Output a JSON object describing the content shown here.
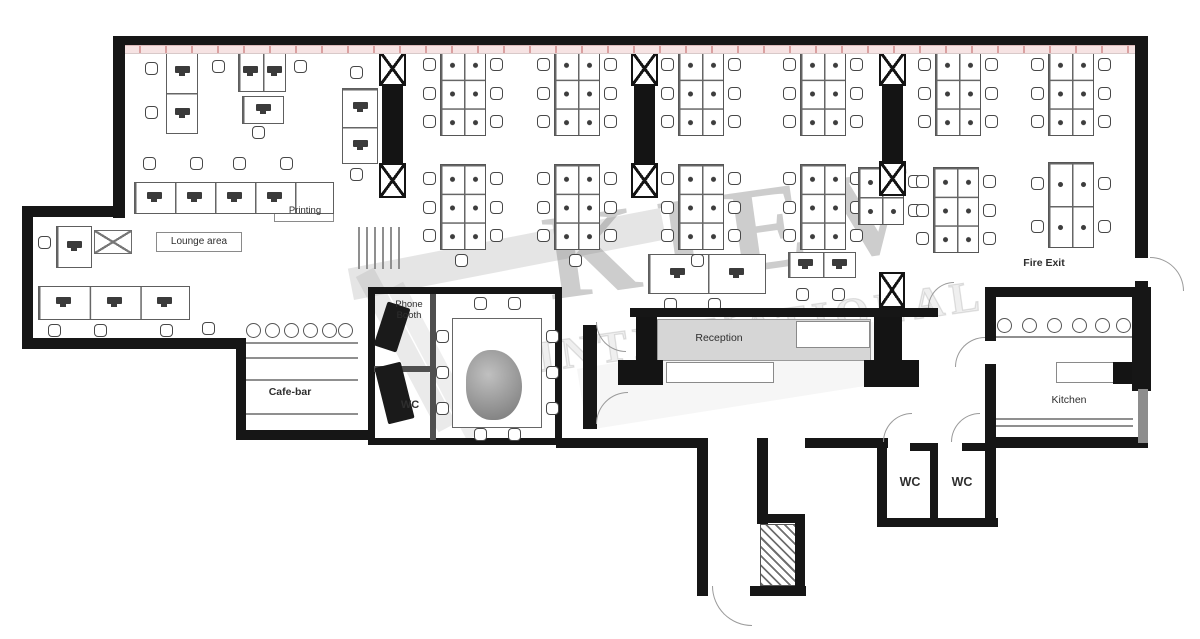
{
  "watermark": {
    "line1": "KIEV",
    "line2": "INTERNATIONAL"
  },
  "labels": {
    "printing": "Printing",
    "lounge": "Lounge area",
    "cafe": "Cafe-bar",
    "phone_booth": "Phone Booth",
    "wc_small": "WC",
    "reception": "Reception",
    "fire_exit": "Fire Exit",
    "kitchen": "Kitchen",
    "wc1": "WC",
    "wc2": "WC"
  },
  "colors": {
    "wall": "#161616",
    "window_band": "#f6e3e3",
    "band_tick": "#c36969",
    "furniture_line": "#5e5e5e",
    "watermark": "rgba(75,75,75,0.28)"
  },
  "plan": {
    "band": {
      "x": 113,
      "y": 45,
      "w": 1035,
      "h": 9
    },
    "walls": [
      {
        "x": 113,
        "y": 36,
        "w": 1035,
        "h": 9
      },
      {
        "x": 113,
        "y": 36,
        "w": 12,
        "h": 182
      },
      {
        "x": 22,
        "y": 206,
        "w": 103,
        "h": 11
      },
      {
        "x": 22,
        "y": 206,
        "w": 11,
        "h": 143
      },
      {
        "x": 22,
        "y": 338,
        "w": 224,
        "h": 11
      },
      {
        "x": 236,
        "y": 338,
        "w": 10,
        "h": 102
      },
      {
        "x": 236,
        "y": 430,
        "w": 137,
        "h": 10
      },
      {
        "x": 556,
        "y": 438,
        "w": 152,
        "h": 10
      },
      {
        "x": 697,
        "y": 438,
        "w": 11,
        "h": 158
      },
      {
        "x": 757,
        "y": 438,
        "w": 11,
        "h": 86
      },
      {
        "x": 757,
        "y": 514,
        "w": 48,
        "h": 9
      },
      {
        "x": 795,
        "y": 514,
        "w": 10,
        "h": 82
      },
      {
        "x": 750,
        "y": 586,
        "w": 56,
        "h": 10
      },
      {
        "x": 805,
        "y": 438,
        "w": 83,
        "h": 10
      },
      {
        "x": 877,
        "y": 438,
        "w": 10,
        "h": 88
      },
      {
        "x": 910,
        "y": 443,
        "w": 27,
        "h": 8
      },
      {
        "x": 930,
        "y": 443,
        "w": 8,
        "h": 83
      },
      {
        "x": 962,
        "y": 443,
        "w": 27,
        "h": 8
      },
      {
        "x": 877,
        "y": 518,
        "w": 121,
        "h": 9
      },
      {
        "x": 985,
        "y": 438,
        "w": 11,
        "h": 88
      },
      {
        "x": 985,
        "y": 437,
        "w": 163,
        "h": 11
      },
      {
        "x": 985,
        "y": 287,
        "w": 11,
        "h": 54
      },
      {
        "x": 985,
        "y": 364,
        "w": 11,
        "h": 80
      },
      {
        "x": 985,
        "y": 287,
        "w": 163,
        "h": 10
      },
      {
        "x": 1132,
        "y": 287,
        "w": 19,
        "h": 104
      },
      {
        "x": 1138,
        "y": 389,
        "w": 10,
        "h": 54,
        "v": "lt"
      },
      {
        "x": 1135,
        "y": 36,
        "w": 13,
        "h": 222
      },
      {
        "x": 1135,
        "y": 281,
        "w": 13,
        "h": 12
      },
      {
        "x": 630,
        "y": 308,
        "w": 308,
        "h": 9
      },
      {
        "x": 583,
        "y": 325,
        "w": 14,
        "h": 104
      }
    ],
    "pillars": [
      {
        "x": 283,
        "y": 37,
        "w": 26,
        "h": 15
      },
      {
        "x": 378,
        "y": 37,
        "w": 26,
        "h": 15
      },
      {
        "x": 497,
        "y": 37,
        "w": 26,
        "h": 15
      },
      {
        "x": 632,
        "y": 37,
        "w": 26,
        "h": 15
      },
      {
        "x": 748,
        "y": 37,
        "w": 26,
        "h": 15
      },
      {
        "x": 878,
        "y": 37,
        "w": 26,
        "h": 15
      },
      {
        "x": 1000,
        "y": 37,
        "w": 26,
        "h": 15
      },
      {
        "x": 382,
        "y": 86,
        "w": 21,
        "h": 78
      },
      {
        "x": 634,
        "y": 86,
        "w": 21,
        "h": 78
      },
      {
        "x": 882,
        "y": 86,
        "w": 21,
        "h": 78
      },
      {
        "x": 636,
        "y": 315,
        "w": 21,
        "h": 48
      },
      {
        "x": 618,
        "y": 360,
        "w": 45,
        "h": 25
      },
      {
        "x": 874,
        "y": 316,
        "w": 28,
        "h": 46
      },
      {
        "x": 864,
        "y": 360,
        "w": 55,
        "h": 27
      },
      {
        "x": 1113,
        "y": 362,
        "w": 22,
        "h": 22
      }
    ],
    "xboxes": [
      {
        "x": 379,
        "y": 51,
        "w": 27,
        "h": 35
      },
      {
        "x": 379,
        "y": 163,
        "w": 27,
        "h": 35
      },
      {
        "x": 631,
        "y": 51,
        "w": 27,
        "h": 35
      },
      {
        "x": 631,
        "y": 163,
        "w": 27,
        "h": 35
      },
      {
        "x": 879,
        "y": 51,
        "w": 27,
        "h": 35
      },
      {
        "x": 879,
        "y": 161,
        "w": 27,
        "h": 35
      },
      {
        "x": 879,
        "y": 272,
        "w": 26,
        "h": 36
      }
    ],
    "xtables": [
      {
        "x": 94,
        "y": 230,
        "w": 38,
        "h": 24
      }
    ],
    "clusters": [
      {
        "x": 440,
        "y": 50
      },
      {
        "x": 554,
        "y": 50
      },
      {
        "x": 678,
        "y": 50
      },
      {
        "x": 800,
        "y": 50
      },
      {
        "x": 935,
        "y": 50
      },
      {
        "x": 1048,
        "y": 50
      },
      {
        "x": 440,
        "y": 164
      },
      {
        "x": 554,
        "y": 164
      },
      {
        "x": 678,
        "y": 164
      },
      {
        "x": 800,
        "y": 164
      },
      {
        "x": 858,
        "y": 167,
        "w": 46,
        "h": 58,
        "r": 2,
        "nl": 1
      },
      {
        "x": 933,
        "y": 167
      },
      {
        "x": 1048,
        "y": 162,
        "r": 2
      }
    ],
    "rows": [
      {
        "x": 134,
        "y": 182,
        "w": 200,
        "h": 32,
        "cells": 5,
        "mons": [
          0,
          1,
          2,
          3
        ]
      },
      {
        "x": 38,
        "y": 286,
        "w": 152,
        "h": 34,
        "cells": 3,
        "mons": [
          0,
          1,
          2
        ]
      },
      {
        "x": 56,
        "y": 226,
        "w": 36,
        "h": 42,
        "cells": 1,
        "mons": [
          0
        ]
      },
      {
        "x": 166,
        "y": 50,
        "w": 32,
        "h": 84,
        "cells": 2,
        "vert": 1,
        "mons": [
          0,
          1
        ]
      },
      {
        "x": 238,
        "y": 52,
        "w": 48,
        "h": 40,
        "cells": 2,
        "mons": [
          0,
          1
        ]
      },
      {
        "x": 242,
        "y": 96,
        "w": 42,
        "h": 28,
        "cells": 1,
        "mons": [
          0
        ]
      },
      {
        "x": 342,
        "y": 88,
        "w": 36,
        "h": 76,
        "cells": 2,
        "vert": 1,
        "mons": [
          0,
          1
        ]
      },
      {
        "x": 648,
        "y": 254,
        "w": 118,
        "h": 40,
        "cells": 2,
        "mons": [
          0,
          1
        ]
      },
      {
        "x": 788,
        "y": 252,
        "w": 68,
        "h": 26,
        "cells": 2,
        "mons": [
          0,
          1
        ]
      }
    ],
    "chairs": [
      {
        "x": 143,
        "y": 157
      },
      {
        "x": 190,
        "y": 157
      },
      {
        "x": 233,
        "y": 157
      },
      {
        "x": 280,
        "y": 157
      },
      {
        "x": 48,
        "y": 324
      },
      {
        "x": 94,
        "y": 324
      },
      {
        "x": 160,
        "y": 324
      },
      {
        "x": 202,
        "y": 322
      },
      {
        "x": 38,
        "y": 236
      },
      {
        "x": 145,
        "y": 62
      },
      {
        "x": 145,
        "y": 106
      },
      {
        "x": 212,
        "y": 60
      },
      {
        "x": 294,
        "y": 60
      },
      {
        "x": 252,
        "y": 126
      },
      {
        "x": 350,
        "y": 66
      },
      {
        "x": 350,
        "y": 168
      },
      {
        "x": 664,
        "y": 298
      },
      {
        "x": 708,
        "y": 298
      },
      {
        "x": 796,
        "y": 288
      },
      {
        "x": 832,
        "y": 288
      },
      {
        "x": 455,
        "y": 254
      },
      {
        "x": 569,
        "y": 254
      },
      {
        "x": 691,
        "y": 254
      },
      {
        "x": 436,
        "y": 330
      },
      {
        "x": 436,
        "y": 366
      },
      {
        "x": 436,
        "y": 402
      },
      {
        "x": 546,
        "y": 330
      },
      {
        "x": 546,
        "y": 366
      },
      {
        "x": 546,
        "y": 402
      },
      {
        "x": 474,
        "y": 297
      },
      {
        "x": 508,
        "y": 297
      },
      {
        "x": 474,
        "y": 428
      },
      {
        "x": 508,
        "y": 428
      }
    ],
    "stools": [
      {
        "x": 246,
        "y": 323
      },
      {
        "x": 265,
        "y": 323
      },
      {
        "x": 284,
        "y": 323
      },
      {
        "x": 303,
        "y": 323
      },
      {
        "x": 322,
        "y": 323
      },
      {
        "x": 338,
        "y": 323
      },
      {
        "x": 997,
        "y": 318
      },
      {
        "x": 1022,
        "y": 318
      },
      {
        "x": 1047,
        "y": 318
      },
      {
        "x": 1072,
        "y": 318
      },
      {
        "x": 1095,
        "y": 318
      },
      {
        "x": 1116,
        "y": 318
      }
    ],
    "doors": [
      {
        "x": 1150,
        "y": 257,
        "r": 34,
        "c": "tr"
      },
      {
        "x": 955,
        "y": 337,
        "r": 30,
        "c": "tl"
      },
      {
        "x": 928,
        "y": 282,
        "r": 26,
        "c": "tl"
      },
      {
        "x": 883,
        "y": 413,
        "r": 29,
        "c": "tl"
      },
      {
        "x": 951,
        "y": 413,
        "r": 29,
        "c": "tl"
      },
      {
        "x": 712,
        "y": 586,
        "r": 40,
        "c": "bl"
      },
      {
        "x": 596,
        "y": 322,
        "r": 30,
        "c": "bl"
      },
      {
        "x": 596,
        "y": 392,
        "r": 32,
        "c": "tl"
      }
    ],
    "lines": [
      {
        "x": 243,
        "y": 342,
        "w": 115,
        "h": 2
      },
      {
        "x": 243,
        "y": 357,
        "w": 115,
        "h": 1.5
      },
      {
        "x": 243,
        "y": 379,
        "w": 115,
        "h": 1.5
      },
      {
        "x": 243,
        "y": 413,
        "w": 115,
        "h": 2
      },
      {
        "x": 996,
        "y": 336,
        "w": 137,
        "h": 2
      },
      {
        "x": 996,
        "y": 418,
        "w": 137,
        "h": 1.5
      },
      {
        "x": 996,
        "y": 425,
        "w": 137,
        "h": 1.5
      },
      {
        "x": 358,
        "y": 227,
        "w": 1.5,
        "h": 42
      },
      {
        "x": 366,
        "y": 227,
        "w": 1.5,
        "h": 42
      },
      {
        "x": 374,
        "y": 227,
        "w": 1.5,
        "h": 42
      },
      {
        "x": 382,
        "y": 227,
        "w": 1.5,
        "h": 42
      },
      {
        "x": 390,
        "y": 227,
        "w": 1.5,
        "h": 42
      },
      {
        "x": 398,
        "y": 227,
        "w": 1.5,
        "h": 42
      },
      {
        "x": 799,
        "y": 333,
        "w": 68,
        "h": 1.5
      }
    ],
    "rects": [
      {
        "x": 368,
        "y": 287,
        "w": 194,
        "h": 158,
        "cls": "blockwall",
        "name": "meeting-room-walls"
      },
      {
        "x": 430,
        "y": 294,
        "w": 6,
        "h": 146,
        "cls": "gdiv",
        "name": "partition-wall"
      },
      {
        "x": 374,
        "y": 366,
        "w": 57,
        "h": 6,
        "cls": "gdiv",
        "name": "partition-wall"
      },
      {
        "x": 452,
        "y": 318,
        "w": 90,
        "h": 110,
        "cls": "mtable",
        "name": "meeting-table"
      },
      {
        "x": 466,
        "y": 350,
        "w": 56,
        "h": 70,
        "cls": "blob",
        "name": "table-centerpiece"
      },
      {
        "x": 380,
        "y": 304,
        "w": 24,
        "h": 46,
        "cls": "furn",
        "rot": 18,
        "name": "booth-furniture"
      },
      {
        "x": 381,
        "y": 364,
        "w": 27,
        "h": 58,
        "cls": "furn",
        "rot": -14,
        "name": "booth-furniture"
      },
      {
        "x": 657,
        "y": 319,
        "w": 214,
        "h": 42,
        "cls": "graydesk",
        "name": "reception-desk"
      },
      {
        "x": 666,
        "y": 362,
        "w": 108,
        "h": 21,
        "cls": "wbox",
        "name": "reception-counter"
      },
      {
        "x": 796,
        "y": 321,
        "w": 74,
        "h": 27,
        "cls": "wbox",
        "name": "waiting-bench"
      },
      {
        "x": 1056,
        "y": 362,
        "w": 60,
        "h": 21,
        "cls": "wbox",
        "name": "kitchen-counter"
      },
      {
        "x": 274,
        "y": 203,
        "w": 60,
        "h": 19,
        "cls": "wbox",
        "name": "printing-label-box"
      },
      {
        "x": 156,
        "y": 232,
        "w": 86,
        "h": 20,
        "cls": "wbox",
        "name": "lounge-label-box"
      }
    ],
    "hatch": {
      "x": 760,
      "y": 524,
      "w": 36,
      "h": 62
    },
    "stripes": [
      {
        "x": 348,
        "y": 238,
        "w": 318,
        "h": 32,
        "rot": -11,
        "o": 0.2
      },
      {
        "x": 318,
        "y": 340,
        "w": 176,
        "h": 20,
        "rot": 62,
        "o": 0.16
      },
      {
        "x": 350,
        "y": 352,
        "w": 170,
        "h": 18,
        "rot": 62,
        "o": 0.13
      },
      {
        "x": 580,
        "y": 345,
        "w": 300,
        "h": 62,
        "rot": -9,
        "o": 0.07
      }
    ]
  }
}
